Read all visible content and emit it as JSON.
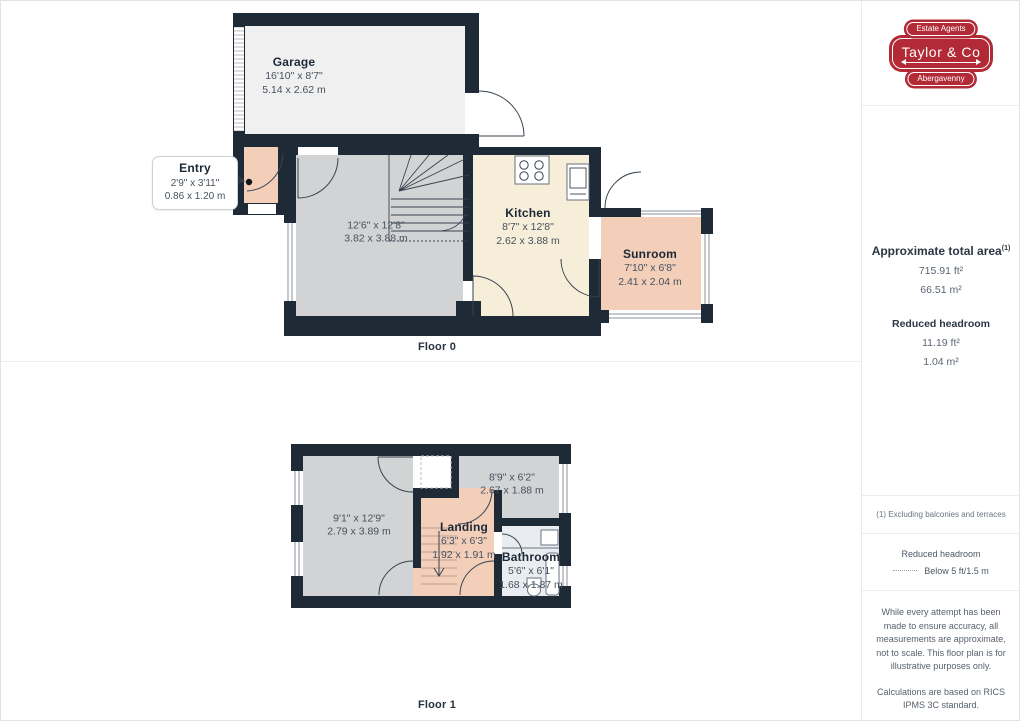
{
  "branding": {
    "estate_agents": "Estate Agents",
    "name": "Taylor & Co",
    "location": "Abergavenny",
    "badge_color": "#b12a36"
  },
  "floor0": {
    "label": "Floor 0",
    "garage": {
      "name": "Garage",
      "imperial": "16'10\" x 8'7\"",
      "metric": "5.14 x 2.62 m"
    },
    "entry": {
      "name": "Entry",
      "imperial": "2'9\" x 3'11\"",
      "metric": "0.86 x 1.20 m"
    },
    "living": {
      "imperial": "12'6\" x 12'8\"",
      "metric": "3.82 x 3.88 m"
    },
    "kitchen": {
      "name": "Kitchen",
      "imperial": "8'7\" x 12'8\"",
      "metric": "2.62 x 3.88 m"
    },
    "sunroom": {
      "name": "Sunroom",
      "imperial": "7'10\" x 6'8\"",
      "metric": "2.41 x 2.04 m"
    }
  },
  "floor1": {
    "label": "Floor 1",
    "bedroom1": {
      "imperial": "9'1\" x 12'9\"",
      "metric": "2.79 x 3.89 m"
    },
    "bedroom2": {
      "imperial": "8'9\" x 6'2\"",
      "metric": "2.67 x 1.88 m"
    },
    "landing": {
      "name": "Landing",
      "imperial": "6'3\" x 6'3\"",
      "metric": "1.92 x 1.91 m"
    },
    "bathroom": {
      "name": "Bathroom",
      "imperial": "5'6\" x 6'1\"",
      "metric": "1.68 x 1.87 m"
    }
  },
  "sidebar": {
    "total_area": {
      "title": "Approximate total area",
      "footnote_marker": "(1)",
      "value_ft": "715.91 ft²",
      "value_m": "66.51 m²"
    },
    "reduced_headroom": {
      "title": "Reduced headroom",
      "value_ft": "11.19 ft²",
      "value_m": "1.04 m²"
    },
    "footnote": "(1) Excluding balconies and terraces",
    "legend": {
      "title": "Reduced headroom",
      "label": "Below 5 ft/1.5 m"
    },
    "disclaimer_1": "While every attempt has been made to ensure accuracy, all measurements are approximate, not to scale. This floor plan is for illustrative purposes only.",
    "disclaimer_2": "Calculations are based on RICS IPMS 3C standard.",
    "brand_normal": "GIRAFFE",
    "brand_bold": "360"
  },
  "colors": {
    "wall": "#1f2a37",
    "room_gray": "#d2d3d4",
    "room_peach": "#f3cfba",
    "room_cream": "#f6eed8",
    "room_garage": "#f0f0f1",
    "room_bath": "#e9edf2",
    "badge_red": "#b12a36"
  }
}
